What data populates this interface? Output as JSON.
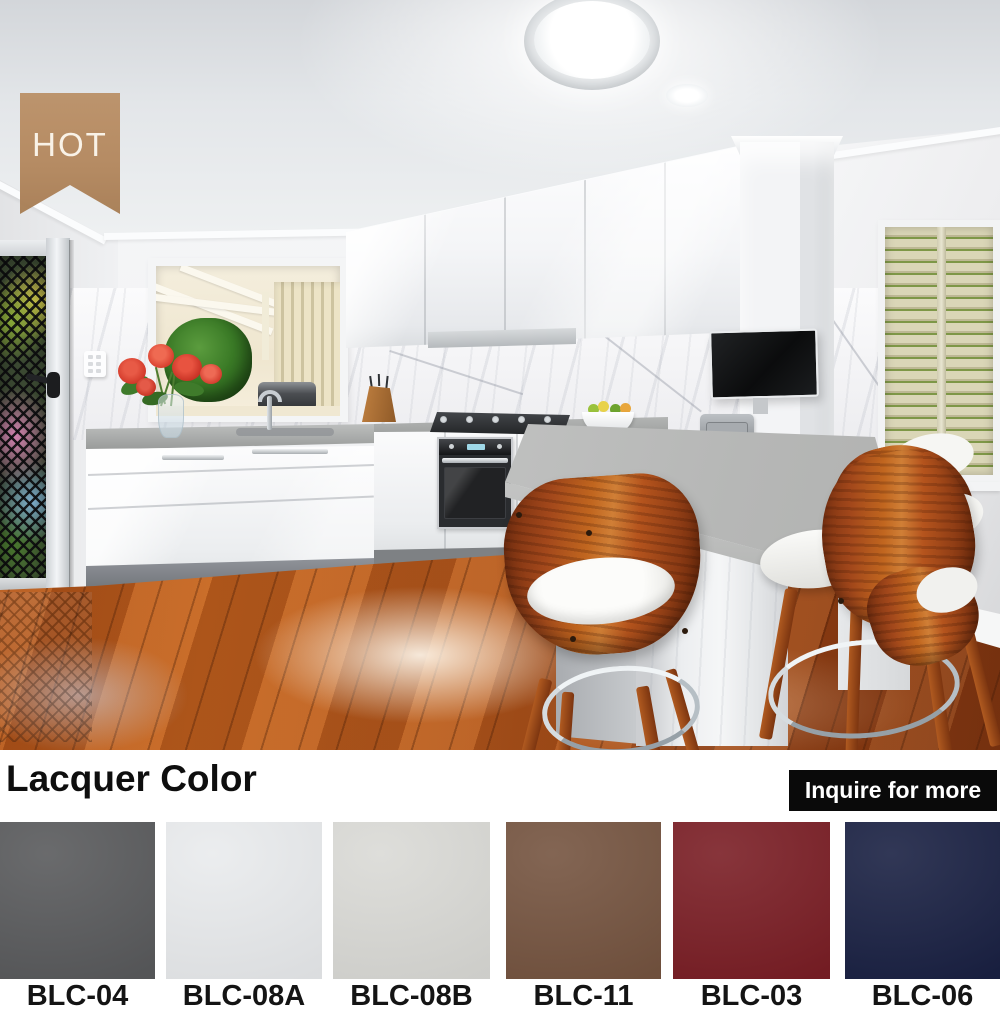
{
  "badge": {
    "label": "HOT",
    "bg_color": "#b3885e"
  },
  "section": {
    "title": "Lacquer Color",
    "button_label": "Inquire for more",
    "button_bg": "#0a0a0a"
  },
  "swatches": [
    {
      "code": "BLC-04",
      "color": "#595a5c"
    },
    {
      "code": "BLC-08A",
      "color": "#e9ebed"
    },
    {
      "code": "BLC-08B",
      "color": "#dadad6"
    },
    {
      "code": "BLC-11",
      "color": "#755440"
    },
    {
      "code": "BLC-03",
      "color": "#7a1e25"
    },
    {
      "code": "BLC-06",
      "color": "#1a2143"
    }
  ]
}
